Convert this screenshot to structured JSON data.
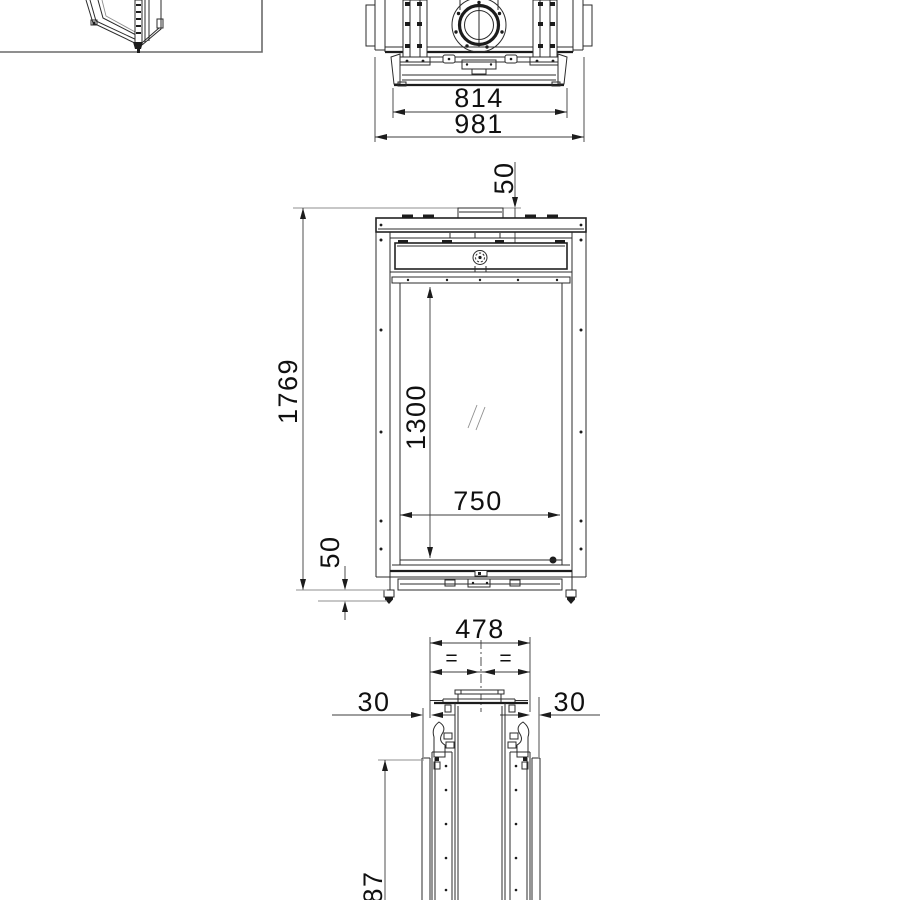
{
  "colors": {
    "background": "#ffffff",
    "line": "#2b2b2b",
    "dimension_line": "#3c3c3c",
    "reference_line": "#8f8f8f",
    "text": "#101010"
  },
  "views": {
    "top_view": {
      "width_inner": "814",
      "width_overall": "981"
    },
    "front_view": {
      "flue_height": "50",
      "height_overall": "1769",
      "glass_height": "1300",
      "glass_width": "750",
      "plinth_height": "50"
    },
    "side_view": {
      "depth_overall": "478",
      "equal_left": "=",
      "equal_right": "=",
      "offset_left": "30",
      "offset_right": "30",
      "height_partial": "87"
    }
  }
}
